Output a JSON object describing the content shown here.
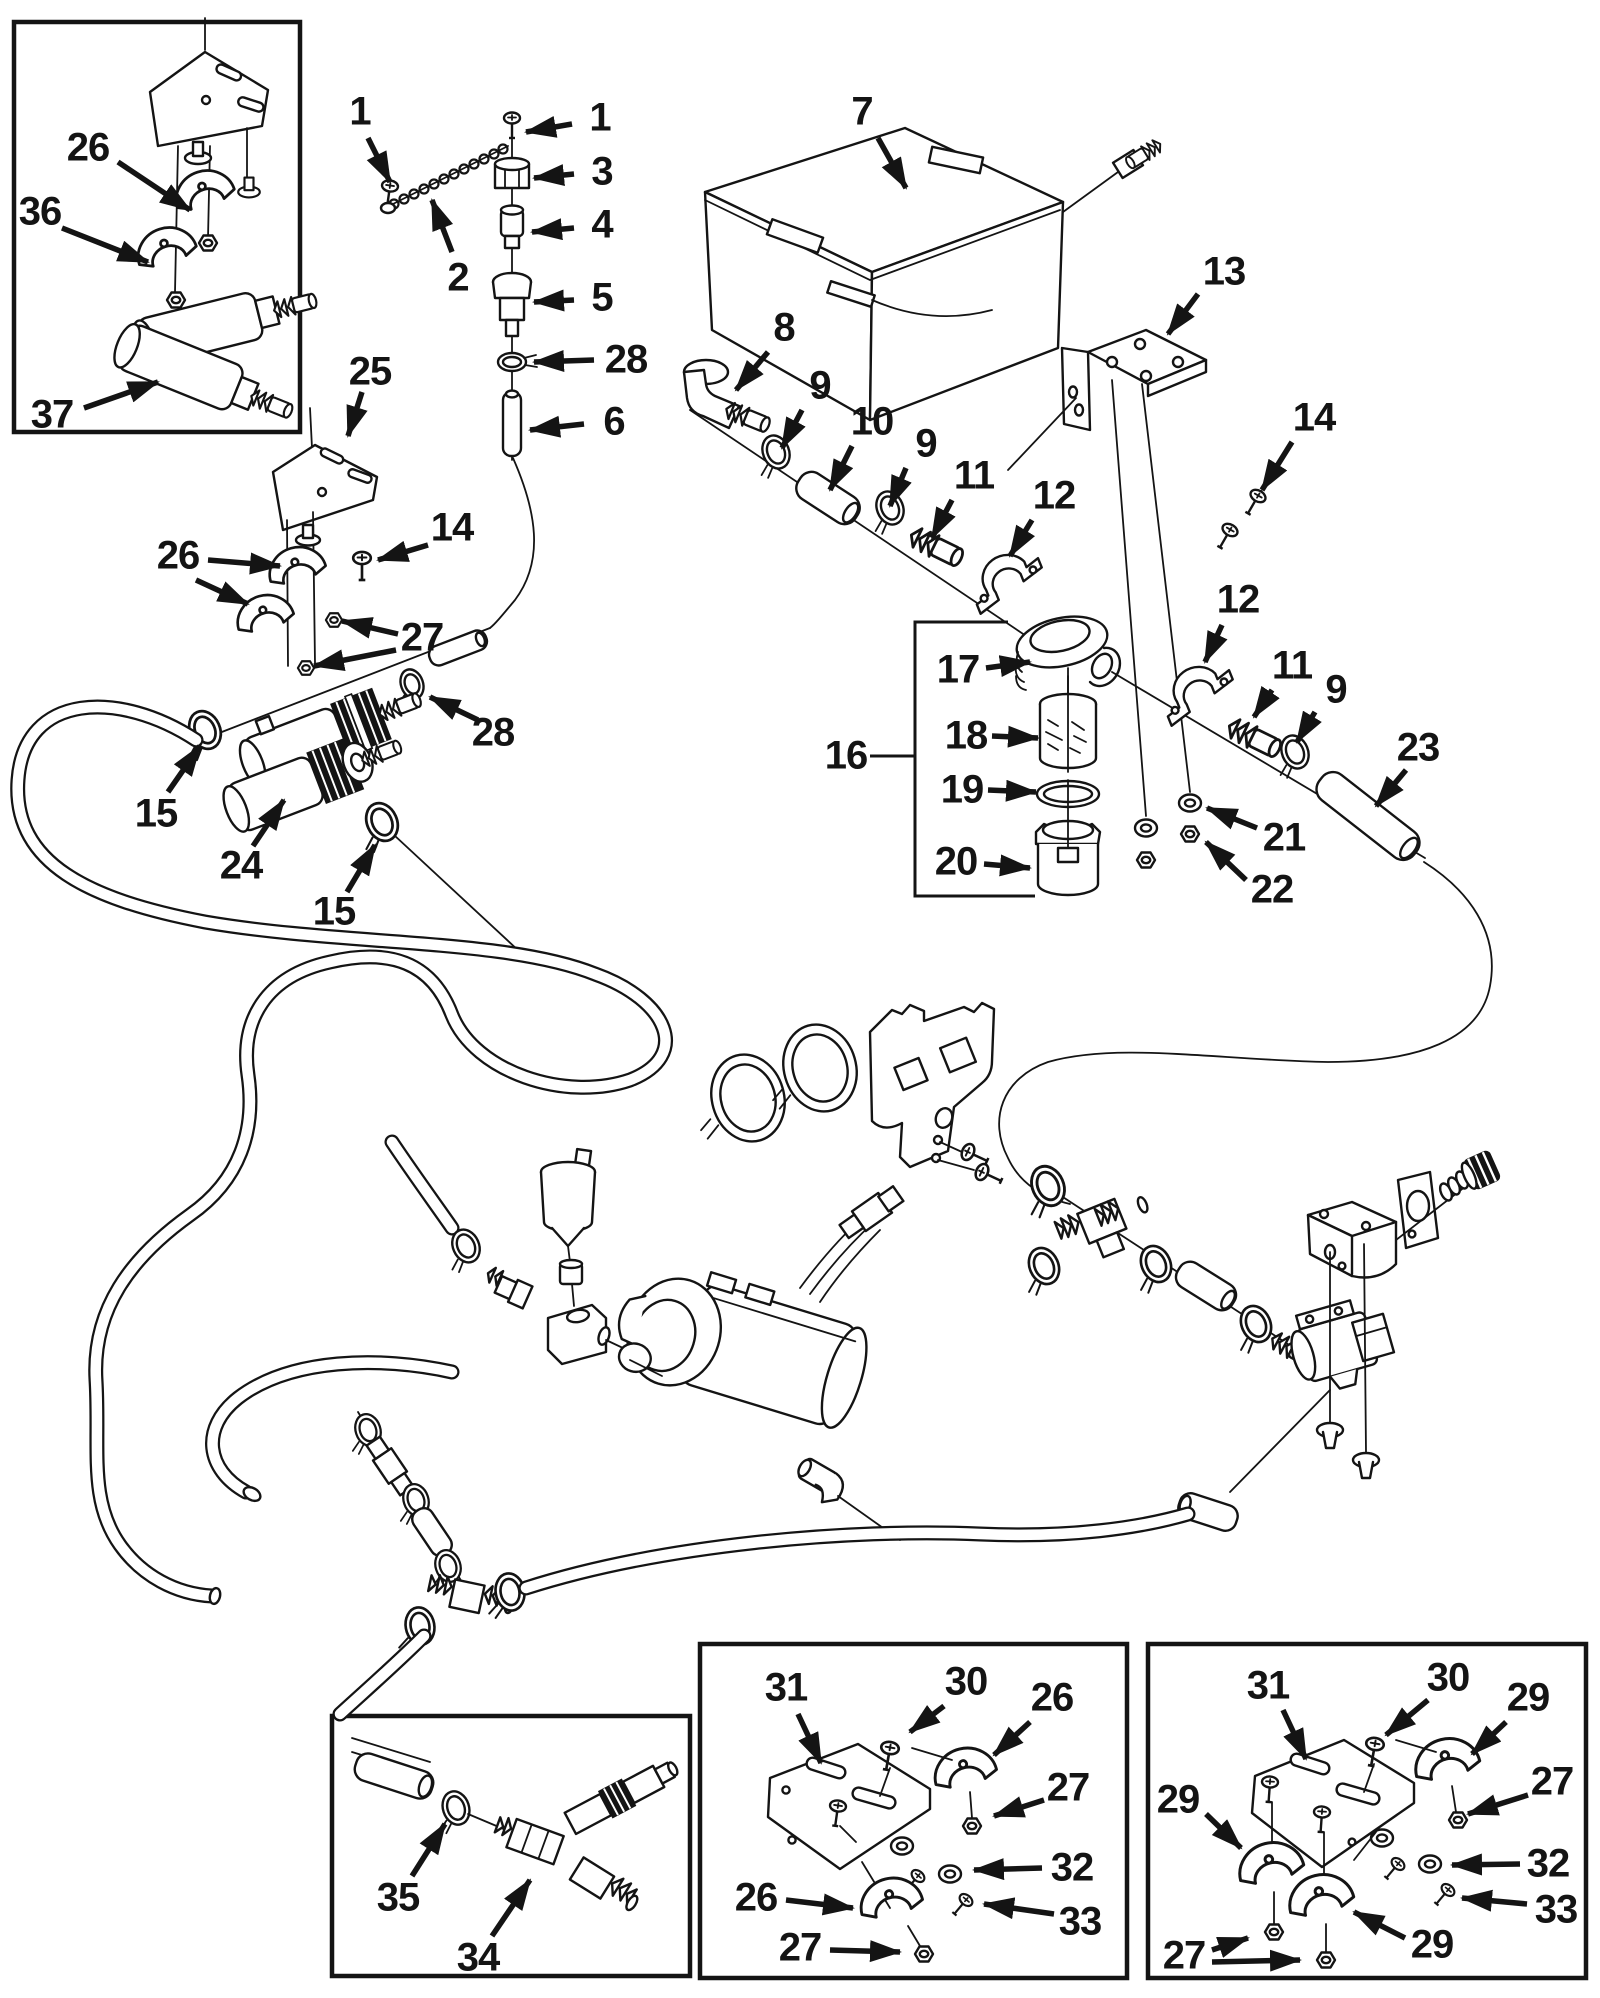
{
  "diagram": {
    "type": "exploded-parts-diagram",
    "background": "#ffffff",
    "ink": "#141414",
    "width": 1600,
    "height": 1998,
    "callouts": [
      {
        "label": "26",
        "x": 88,
        "y": 148,
        "arrows": [
          [
            118,
            162,
            190,
            210
          ]
        ]
      },
      {
        "label": "36",
        "x": 40,
        "y": 212,
        "arrows": [
          [
            62,
            228,
            148,
            262
          ]
        ]
      },
      {
        "label": "37",
        "x": 52,
        "y": 415,
        "arrows": [
          [
            84,
            408,
            158,
            382
          ]
        ]
      },
      {
        "label": "1",
        "x": 360,
        "y": 112,
        "arrows": [
          [
            368,
            138,
            390,
            182
          ]
        ]
      },
      {
        "label": "2",
        "x": 458,
        "y": 278,
        "arrows": [
          [
            452,
            252,
            432,
            200
          ]
        ]
      },
      {
        "label": "1",
        "x": 600,
        "y": 118,
        "arrows": [
          [
            572,
            124,
            526,
            132
          ]
        ]
      },
      {
        "label": "3",
        "x": 602,
        "y": 172,
        "arrows": [
          [
            574,
            174,
            534,
            178
          ]
        ]
      },
      {
        "label": "4",
        "x": 602,
        "y": 225,
        "arrows": [
          [
            574,
            228,
            532,
            232
          ]
        ]
      },
      {
        "label": "5",
        "x": 602,
        "y": 298,
        "arrows": [
          [
            574,
            300,
            534,
            302
          ]
        ]
      },
      {
        "label": "28",
        "x": 626,
        "y": 360,
        "arrows": [
          [
            594,
            360,
            534,
            362
          ]
        ]
      },
      {
        "label": "6",
        "x": 614,
        "y": 422,
        "arrows": [
          [
            584,
            424,
            530,
            430
          ]
        ]
      },
      {
        "label": "7",
        "x": 862,
        "y": 112,
        "arrows": [
          [
            878,
            138,
            906,
            188
          ]
        ]
      },
      {
        "label": "13",
        "x": 1224,
        "y": 272,
        "arrows": [
          [
            1198,
            294,
            1168,
            334
          ]
        ]
      },
      {
        "label": "14",
        "x": 1314,
        "y": 418,
        "arrows": [
          [
            1292,
            442,
            1262,
            490
          ]
        ]
      },
      {
        "label": "8",
        "x": 784,
        "y": 328,
        "arrows": [
          [
            768,
            352,
            736,
            390
          ]
        ]
      },
      {
        "label": "9",
        "x": 820,
        "y": 386,
        "arrows": [
          [
            802,
            410,
            782,
            448
          ]
        ]
      },
      {
        "label": "10",
        "x": 872,
        "y": 422,
        "arrows": [
          [
            852,
            446,
            830,
            490
          ]
        ]
      },
      {
        "label": "9",
        "x": 926,
        "y": 444,
        "arrows": [
          [
            906,
            468,
            890,
            506
          ]
        ]
      },
      {
        "label": "11",
        "x": 974,
        "y": 476,
        "arrows": [
          [
            952,
            500,
            932,
            538
          ]
        ]
      },
      {
        "label": "12",
        "x": 1054,
        "y": 496,
        "arrows": [
          [
            1032,
            520,
            1010,
            556
          ]
        ]
      },
      {
        "label": "16",
        "x": 846,
        "y": 756,
        "lines": [
          [
            870,
            756,
            914,
            756
          ]
        ]
      },
      {
        "label": "17",
        "x": 958,
        "y": 670,
        "arrows": [
          [
            986,
            668,
            1030,
            662
          ]
        ]
      },
      {
        "label": "18",
        "x": 966,
        "y": 736,
        "arrows": [
          [
            992,
            736,
            1038,
            738
          ]
        ]
      },
      {
        "label": "19",
        "x": 962,
        "y": 790,
        "arrows": [
          [
            988,
            790,
            1036,
            792
          ]
        ]
      },
      {
        "label": "20",
        "x": 956,
        "y": 862,
        "arrows": [
          [
            984,
            864,
            1030,
            868
          ]
        ]
      },
      {
        "label": "12",
        "x": 1238,
        "y": 600,
        "arrows": [
          [
            1222,
            625,
            1205,
            662
          ]
        ]
      },
      {
        "label": "11",
        "x": 1292,
        "y": 666,
        "arrows": [
          [
            1272,
            690,
            1254,
            717
          ]
        ]
      },
      {
        "label": "9",
        "x": 1336,
        "y": 690,
        "arrows": [
          [
            1315,
            712,
            1297,
            742
          ]
        ]
      },
      {
        "label": "21",
        "x": 1284,
        "y": 838,
        "arrows": [
          [
            1257,
            828,
            1207,
            808
          ]
        ]
      },
      {
        "label": "22",
        "x": 1272,
        "y": 890,
        "arrows": [
          [
            1246,
            880,
            1206,
            842
          ]
        ]
      },
      {
        "label": "23",
        "x": 1418,
        "y": 748,
        "arrows": [
          [
            1406,
            770,
            1376,
            806
          ]
        ]
      },
      {
        "label": "25",
        "x": 370,
        "y": 372,
        "arrows": [
          [
            362,
            392,
            348,
            436
          ]
        ]
      },
      {
        "label": "14",
        "x": 452,
        "y": 528,
        "arrows": [
          [
            428,
            545,
            378,
            560
          ]
        ]
      },
      {
        "label": "26",
        "x": 178,
        "y": 556,
        "arrows": [
          [
            208,
            560,
            280,
            566
          ],
          [
            196,
            580,
            248,
            604
          ]
        ]
      },
      {
        "label": "27",
        "x": 422,
        "y": 638,
        "arrows": [
          [
            398,
            634,
            342,
            621
          ],
          [
            396,
            650,
            314,
            666
          ]
        ]
      },
      {
        "label": "28",
        "x": 493,
        "y": 733,
        "arrows": [
          [
            478,
            720,
            430,
            697
          ]
        ]
      },
      {
        "label": "15",
        "x": 156,
        "y": 814,
        "arrows": [
          [
            168,
            792,
            200,
            746
          ]
        ]
      },
      {
        "label": "24",
        "x": 241,
        "y": 866,
        "arrows": [
          [
            253,
            846,
            284,
            800
          ]
        ]
      },
      {
        "label": "15",
        "x": 334,
        "y": 912,
        "arrows": [
          [
            347,
            892,
            375,
            845
          ]
        ]
      },
      {
        "label": "35",
        "x": 398,
        "y": 1898,
        "arrows": [
          [
            412,
            1876,
            445,
            1824
          ]
        ]
      },
      {
        "label": "34",
        "x": 478,
        "y": 1958,
        "arrows": [
          [
            492,
            1936,
            530,
            1880
          ]
        ]
      },
      {
        "label": "31",
        "x": 786,
        "y": 1688,
        "arrows": [
          [
            798,
            1714,
            821,
            1763
          ]
        ]
      },
      {
        "label": "30",
        "x": 966,
        "y": 1682,
        "arrows": [
          [
            944,
            1706,
            910,
            1732
          ]
        ]
      },
      {
        "label": "26",
        "x": 1052,
        "y": 1698,
        "arrows": [
          [
            1030,
            1722,
            994,
            1755
          ]
        ]
      },
      {
        "label": "27",
        "x": 1068,
        "y": 1788,
        "arrows": [
          [
            1044,
            1800,
            994,
            1816
          ]
        ]
      },
      {
        "label": "32",
        "x": 1072,
        "y": 1868,
        "arrows": [
          [
            1042,
            1868,
            974,
            1870
          ]
        ]
      },
      {
        "label": "33",
        "x": 1080,
        "y": 1922,
        "arrows": [
          [
            1054,
            1914,
            984,
            1904
          ]
        ]
      },
      {
        "label": "26",
        "x": 756,
        "y": 1898,
        "arrows": [
          [
            786,
            1900,
            853,
            1908
          ]
        ]
      },
      {
        "label": "27",
        "x": 800,
        "y": 1948,
        "arrows": [
          [
            830,
            1950,
            900,
            1952
          ]
        ]
      },
      {
        "label": "31",
        "x": 1268,
        "y": 1686,
        "arrows": [
          [
            1283,
            1710,
            1306,
            1759
          ]
        ]
      },
      {
        "label": "30",
        "x": 1448,
        "y": 1678,
        "arrows": [
          [
            1428,
            1700,
            1386,
            1735
          ]
        ]
      },
      {
        "label": "29",
        "x": 1528,
        "y": 1698,
        "arrows": [
          [
            1506,
            1722,
            1472,
            1754
          ]
        ]
      },
      {
        "label": "27",
        "x": 1552,
        "y": 1782,
        "arrows": [
          [
            1528,
            1795,
            1468,
            1814
          ]
        ]
      },
      {
        "label": "32",
        "x": 1548,
        "y": 1864,
        "arrows": [
          [
            1520,
            1864,
            1452,
            1865
          ]
        ]
      },
      {
        "label": "33",
        "x": 1556,
        "y": 1910,
        "arrows": [
          [
            1527,
            1904,
            1462,
            1898
          ]
        ]
      },
      {
        "label": "29",
        "x": 1178,
        "y": 1800,
        "arrows": [
          [
            1206,
            1814,
            1241,
            1848
          ]
        ]
      },
      {
        "label": "29",
        "x": 1432,
        "y": 1945,
        "arrows": [
          [
            1405,
            1938,
            1354,
            1912
          ]
        ]
      },
      {
        "label": "27",
        "x": 1184,
        "y": 1956,
        "arrows": [
          [
            1212,
            1950,
            1248,
            1938
          ],
          [
            1212,
            1962,
            1300,
            1960
          ]
        ]
      }
    ]
  }
}
